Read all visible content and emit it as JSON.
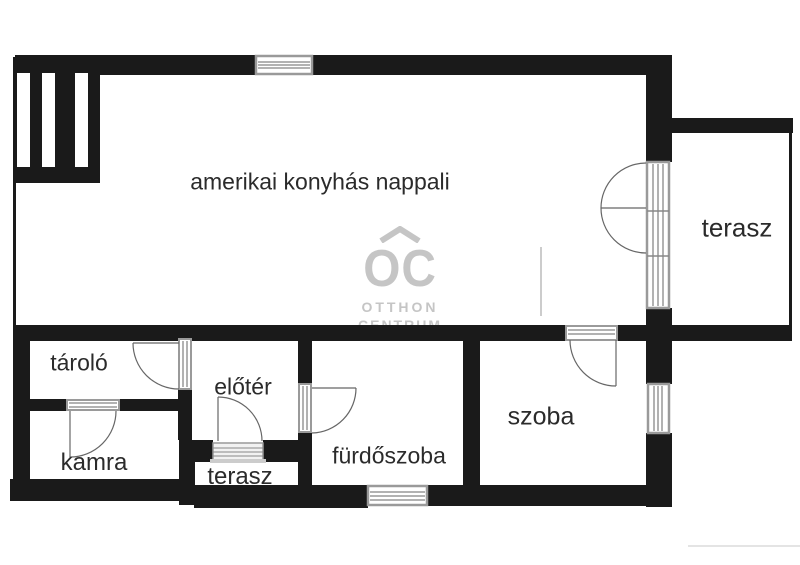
{
  "plan": {
    "rooms": {
      "nappali": {
        "label": "amerikai konyhás nappali"
      },
      "terasz_jobb": {
        "label": "terasz"
      },
      "tarolo": {
        "label": "tároló"
      },
      "eloter": {
        "label": "előtér"
      },
      "kamra": {
        "label": "kamra"
      },
      "terasz_also": {
        "label": "terasz"
      },
      "furdoszoba": {
        "label": "fürdőszoba"
      },
      "szoba": {
        "label": "szoba"
      }
    },
    "watermark": {
      "monogram": "OC",
      "line1": "OTTHON",
      "line2": "CENTRUM",
      "roof_icon": "roof-chevron-icon"
    },
    "colors": {
      "wall": "#1a1a1a",
      "paper": "#ffffff",
      "watermark_gray": "#c5c5c5",
      "door_line_gray": "#666666",
      "window_frame_gray": "#9a9a9a",
      "label_text": "#2b2b2b"
    },
    "symbols": {
      "doors": [
        "terrace-double-door",
        "szoba-door",
        "tarolo-door",
        "kamra-door",
        "entrance-door",
        "furdoszoba-door"
      ],
      "windows": [
        "top-window",
        "main-right-window",
        "szoba-right-window",
        "furdoszoba-bottom-window"
      ],
      "steps": "entrance-steps",
      "closet": "built-in-closet-bars"
    }
  }
}
